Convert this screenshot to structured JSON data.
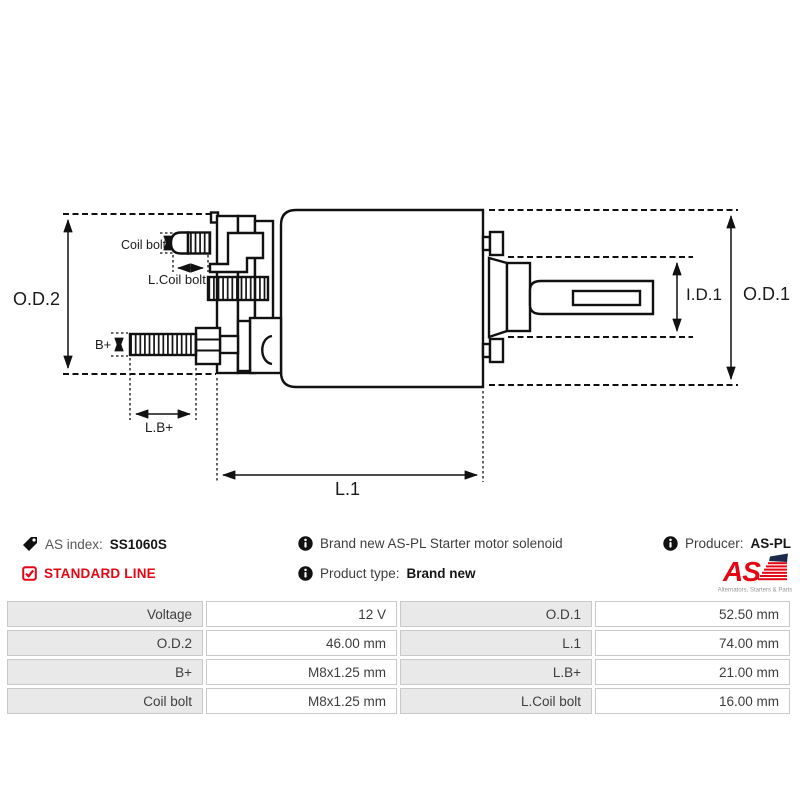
{
  "colors": {
    "accent_red": "#e30613",
    "line_black": "#111111",
    "table_label_bg": "#e9e9e9",
    "table_border": "#c9c9c9",
    "logo_navy": "#1b2a4a"
  },
  "diagram": {
    "labels": {
      "od2": "O.D.2",
      "od1": "O.D.1",
      "id1": "I.D.1",
      "l1": "L.1",
      "lb_plus": "L.B+",
      "b_plus": "B+",
      "coil_bolt": "Coil bolt",
      "l_coil_bolt": "L.Coil bolt"
    }
  },
  "header": {
    "as_index_label": "AS index:",
    "as_index_value": "SS1060S",
    "standard_line": "STANDARD LINE",
    "description": "Brand new AS-PL Starter motor solenoid",
    "product_type_label": "Product type:",
    "product_type_value": "Brand new",
    "producer_label": "Producer:",
    "producer_value": "AS-PL",
    "logo_text": "AS",
    "logo_tagline": "Alternators, Starters & Parts"
  },
  "spec_table": {
    "rows": [
      {
        "c0": "Voltage",
        "c1": "12 V",
        "c2": "O.D.1",
        "c3": "52.50 mm"
      },
      {
        "c0": "O.D.2",
        "c1": "46.00 mm",
        "c2": "L.1",
        "c3": "74.00 mm"
      },
      {
        "c0": "B+",
        "c1": "M8x1.25 mm",
        "c2": "L.B+",
        "c3": "21.00 mm"
      },
      {
        "c0": "Coil bolt",
        "c1": "M8x1.25 mm",
        "c2": "L.Coil bolt",
        "c3": "16.00 mm"
      }
    ]
  }
}
